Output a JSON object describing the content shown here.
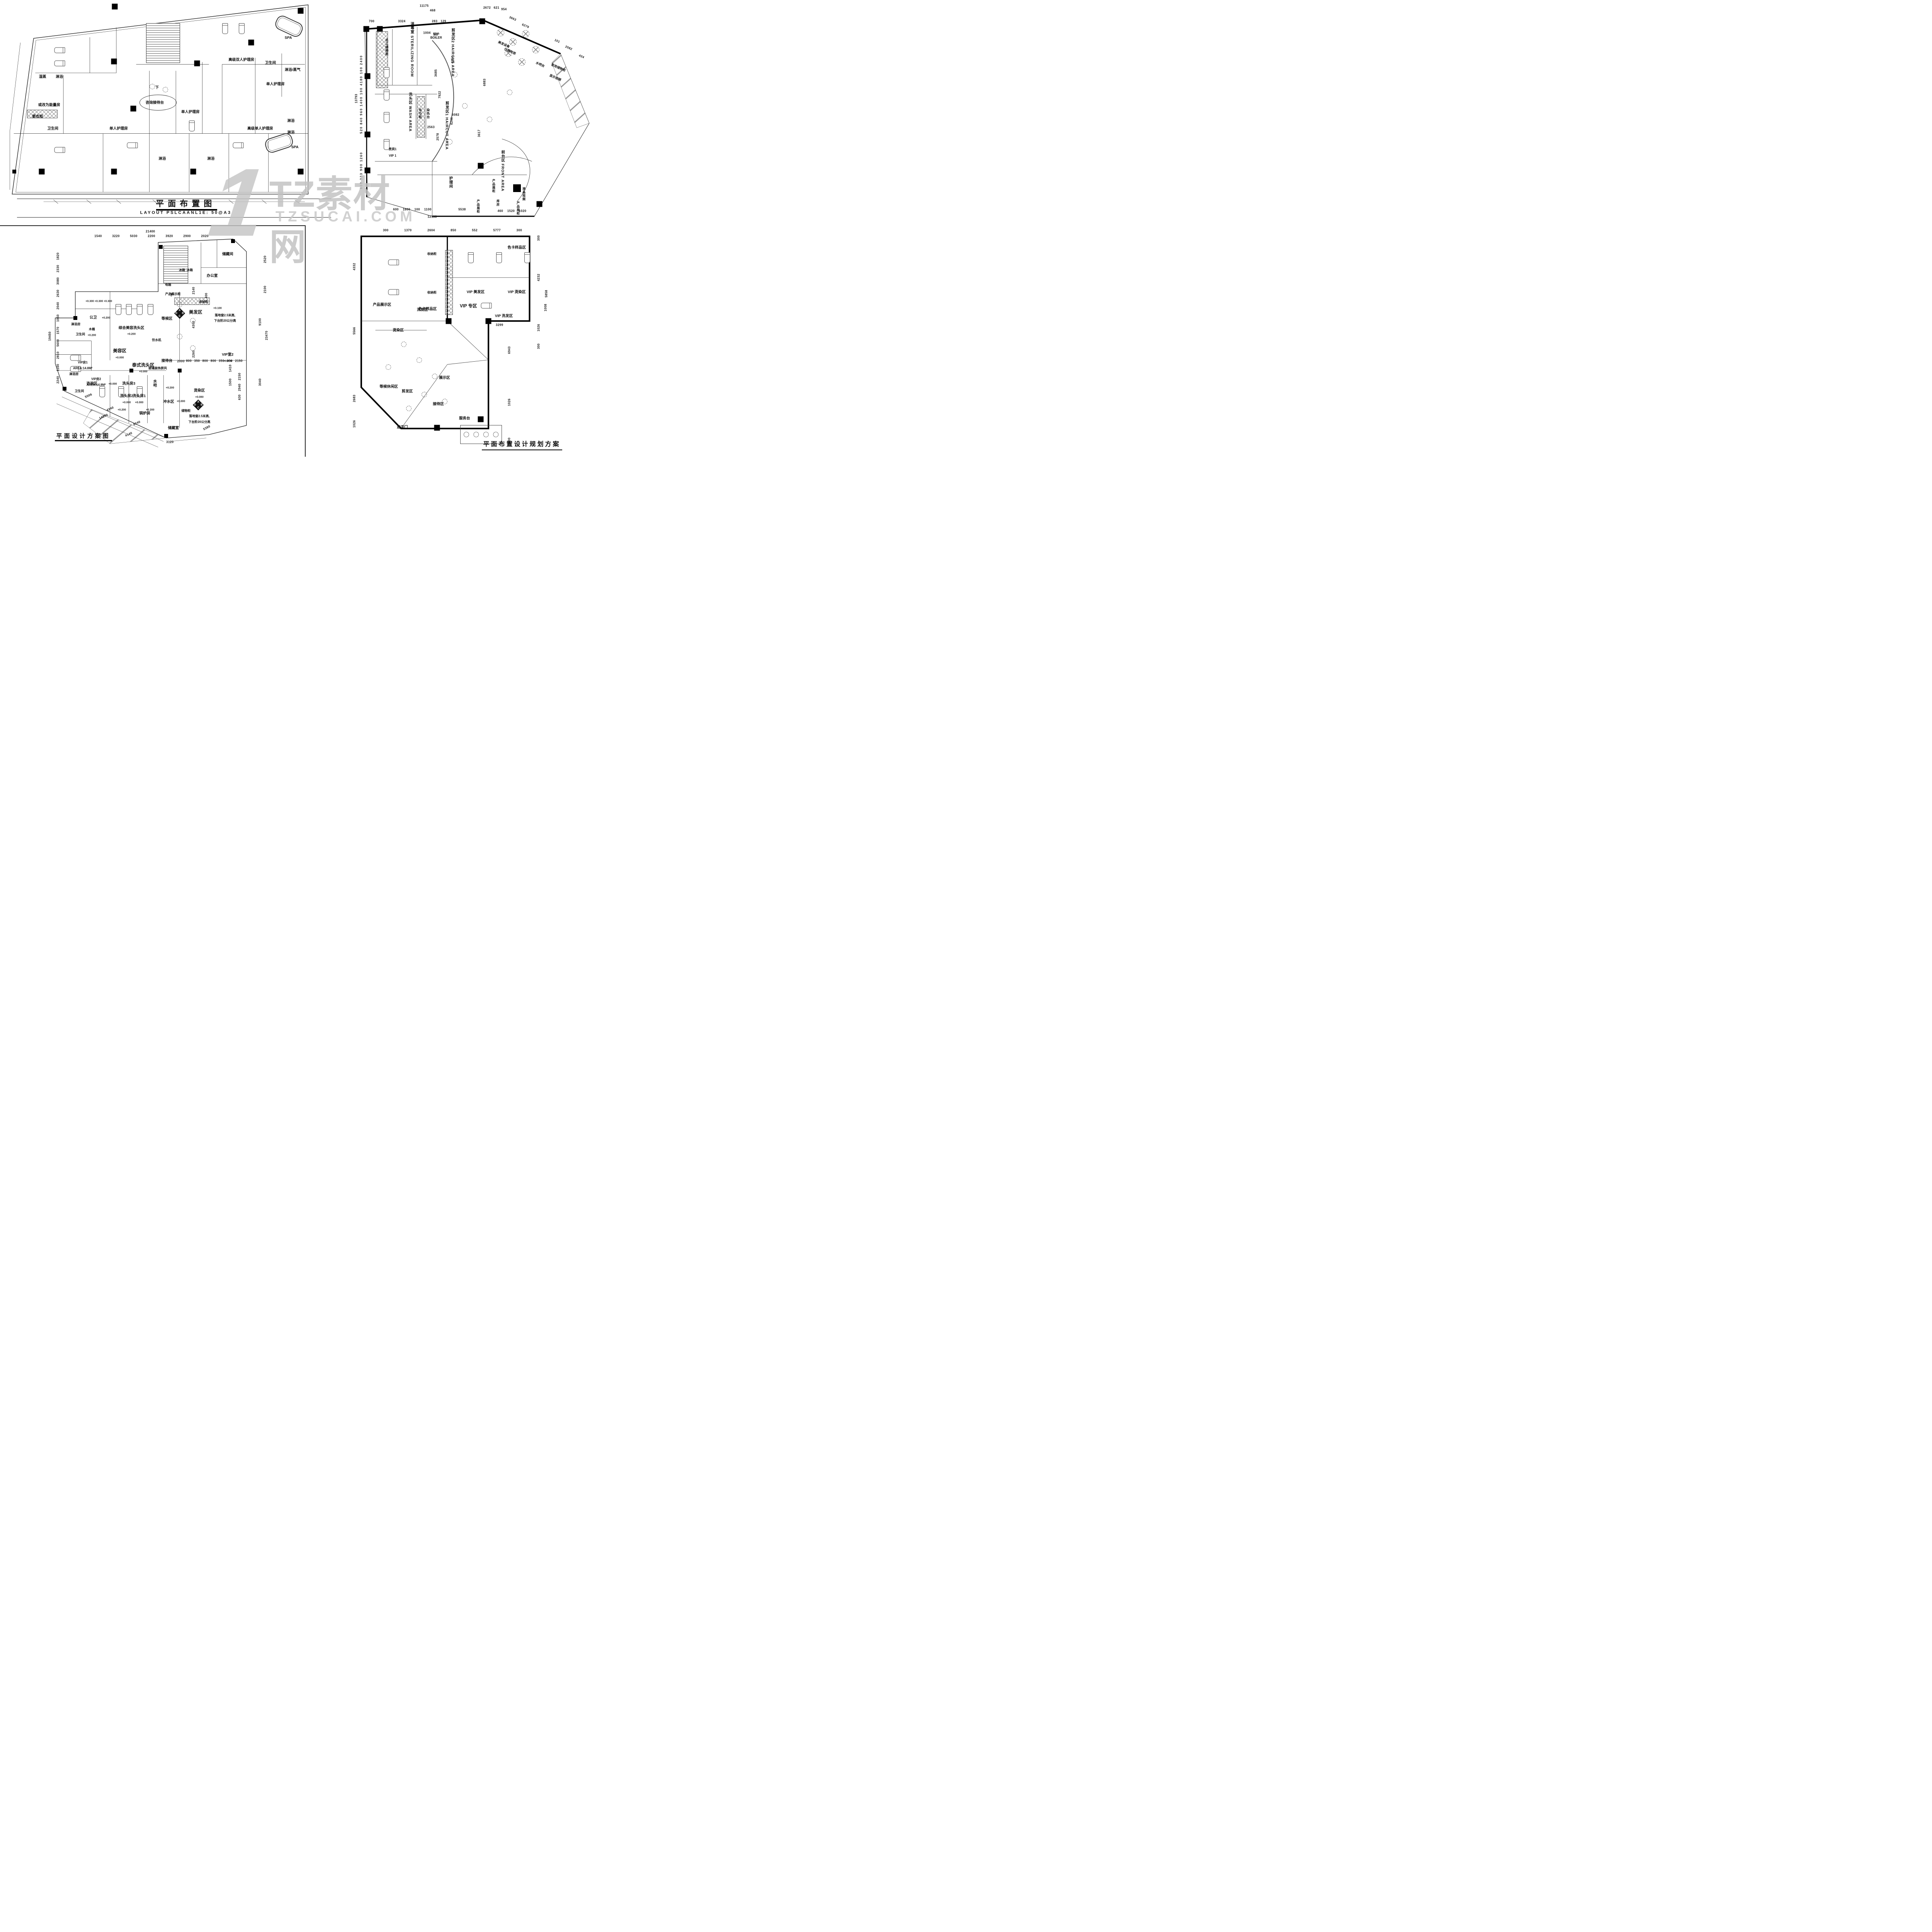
{
  "watermark": {
    "big_glyph": "1",
    "brand": "TZ素材网",
    "domain": "TZSUCAI.COM"
  },
  "plan1": {
    "title": "平面布置图",
    "subtitle": "LAYOUT   PSLCAANL1E: 50@A3",
    "labels": {
      "wet_steam": "湿蒸",
      "shower_a": "淋浴",
      "energy_room": "或改为能量房",
      "wardrobe": "更衣柜",
      "toilet_a": "卫生间",
      "single_care_a": "单人护理房",
      "down": "下",
      "reception": "咨询接待台",
      "single_care_b": "单人护理房",
      "deluxe_double": "高级双人护理房",
      "toilet_b": "卫生间",
      "spa_a": "SPA",
      "shower_steam": "淋浴/蒸气",
      "single_care_c": "单人护理房",
      "deluxe_single": "高级单人护理房",
      "shower_b": "淋浴",
      "shower_c": "淋浴",
      "spa_b": "SPA",
      "shower_d": "淋浴",
      "shower_e": "淋浴"
    }
  },
  "plan2": {
    "labels": {
      "staff_lockers": "员工储物柜",
      "sterilizing": "消毒室 STERILIZING ROOM",
      "boiler": "锅炉 BOILER",
      "equip_storage_1": "美发设备",
      "equip_storage_2": "仪器存放",
      "haircut2": "剪发区2 HAIRCUT AREA",
      "haircut1": "剪发区1 HAIRCUT AREA",
      "wash": "洗头区 WASH AREA",
      "towel_cabinet": "毛巾柜",
      "dye_table": "染色台",
      "vip1_cn": "贵宾1",
      "vip1_en": "VIP 1",
      "care_room": "护理间",
      "front": "前台区 FRONT AREA",
      "product_case_a": "产品展柜",
      "product_case_b": "产品展柜",
      "product_case_c": "产品展柜",
      "storeroom": "库房",
      "lcd_video": "液晶视频",
      "water_bar": "水吧台",
      "guest_lockers": "客用储物柜",
      "display_video": "显示视频"
    },
    "dims": {
      "d11175": "11175",
      "d468": "468",
      "d700": "700",
      "d3324": "3324",
      "d283": "283",
      "d129": "129",
      "d1004": "1004",
      "d2672": "2672",
      "d621": "621",
      "d954": "954",
      "d3663": "3663",
      "d6279": "6279",
      "d101": "101",
      "d2082": "2082",
      "d434": "434",
      "left_chain": "520 840 960 1400 100 4180 100 2400",
      "left_total": "13793",
      "lower_left": "800 333 900 1260",
      "bottom_chain": "600 1800 100 1100",
      "d5538": "5538",
      "bottom_total": "12138",
      "bottom_right": "460 1520 1020",
      "d4254": "4254",
      "d3685": "3685",
      "d7922": "7922",
      "d6883": "6883",
      "d6082": "6082",
      "d6246": "6246",
      "d2563": "2563",
      "d2578": "2578",
      "d3617": "3617"
    }
  },
  "plan3": {
    "title": "平面设计方案图",
    "labels": {
      "storage_room": "储藏间",
      "office": "办公室",
      "fridge_a": "冰箱",
      "fridge_b": "冰箱",
      "down": "下",
      "elec_box": "电箱",
      "product_display": "产品展示柜",
      "storage_cab": "收纳柜",
      "public_wc": "公卫",
      "shower_room_a": "淋浴房",
      "toilet_a": "卫生间",
      "wood_tub": "木桶",
      "combined_wash": "综合美容洗头区",
      "waiting": "等候区",
      "water_dispenser": "饮水机",
      "beauty": "美容区",
      "vip_room1": "VIP房1",
      "vip_room1_area": "AREA:14.8M²",
      "consult": "咨询区",
      "shower_room_b": "淋浴房",
      "toilet_b": "卫生间",
      "wash_room3": "洗头房3",
      "water_bar": "水吧",
      "reception_desk": "接待台",
      "thai_wash": "泰式洗头区",
      "glass_screen": "玻璃装饰屏风",
      "vip_room2": "VIP房2",
      "vip_room2_area": "AREA:14.8M²",
      "wash_room2": "洗头房2",
      "wash_room1": "洗头房1",
      "rinse": "冲水区",
      "perm_dye": "烫染区",
      "hair": "美发区",
      "vip_suite2": "VIP室2",
      "boiler_room": "锅炉房",
      "locker": "储物柜",
      "store_room": "储藏室",
      "window_note1": "落地窗2.5米高,",
      "window_note2": "下台阶20公分高"
    },
    "levels": {
      "p300": "+0.300",
      "p200": "+0.200",
      "p100": "+0.100",
      "p080": "+0.080",
      "p000": "+0.000"
    },
    "compass": {
      "n": "A",
      "e": "B",
      "s": "C",
      "w": "D"
    },
    "dims": {
      "top_total": "21400",
      "top_chain": "1540 3220 5030 2200 3920 2900 2020",
      "left_chain": "2240 1160 2810 5600 1570 1050 2040 2630 3080 2330 1820",
      "left_total": "19450",
      "d2520": "2520",
      "d2100": "2100",
      "d9100": "9100",
      "d23470": "23470",
      "d3040": "3040",
      "d2140a": "2140",
      "d4300": "4300",
      "d2260": "2260",
      "d400": "400",
      "d2000": "2000",
      "mid_chain": "800 350 800 800 350 800 2150",
      "d1410": "1410",
      "d1500": "1500",
      "right_small": "630 2940 2150",
      "d5506": "5506",
      "d14200": "14200",
      "d4240": "4240",
      "d9240": "9240",
      "d4140": "4140",
      "d3120": "3120",
      "d5380": "5380"
    }
  },
  "plan4": {
    "title": "平面布置设计规划方案",
    "labels": {
      "storage_cab_a": "收纳柜",
      "storage_cab_b": "收纳柜",
      "wash": "洗发区",
      "color_card_a": "色卡样品区",
      "vip_hair": "VIP 美发区",
      "vip_dye": "VIP 烫染区",
      "vip_wash": "VIP 洗发区",
      "vip_zone": "VIP 专区",
      "color_card_b": "色卡样品区",
      "product_display": "产品展示区",
      "dye": "烫染区",
      "waiting": "等候休闲区",
      "haircut": "剪发区",
      "display": "展示区",
      "reception": "接待区",
      "service_desk": "服务台",
      "entrance": "进店门"
    },
    "dims": {
      "top_chain": "300 1370 2604 850 552 5777 300",
      "d300a": "300",
      "d4232": "4232",
      "d5858": "5858",
      "d1026a": "1026",
      "d300b": "300",
      "d4332": "4332",
      "d5566": "5566",
      "d2683": "2683",
      "d1026b": "1026",
      "d1008": "1008",
      "d3299": "3299",
      "d6943": "6943",
      "d1026c": "1026",
      "d1600": "1600"
    }
  }
}
